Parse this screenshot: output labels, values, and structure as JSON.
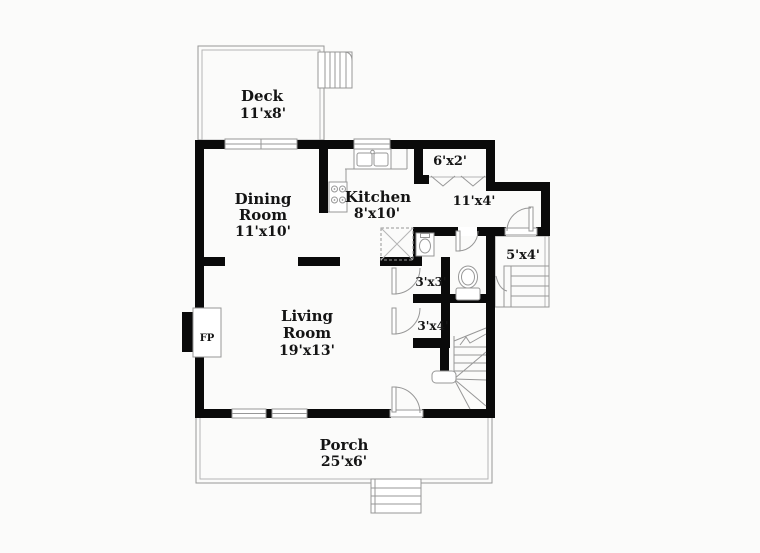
{
  "plan_title": "First floor plan",
  "colors": {
    "background": "#fbfbfa",
    "walls": "#0a0a0a",
    "thin_lines": "#979797",
    "text": "#141414"
  },
  "rooms": {
    "deck": {
      "name": "Deck",
      "dims": "11'x8'"
    },
    "dining_room": {
      "name_line1": "Dining",
      "name_line2": "Room",
      "dims": "11'x10'"
    },
    "kitchen": {
      "name": "Kitchen",
      "dims": "8'x10'"
    },
    "pantry_closet": {
      "dims": "6'x2'"
    },
    "hallway": {
      "dims": "11'x4'"
    },
    "side_stoop": {
      "dims": "5'x4'"
    },
    "closet_a": {
      "dims": "3'x3'"
    },
    "closet_b": {
      "dims": "3'x4'"
    },
    "living_room": {
      "name_line1": "Living",
      "name_line2": "Room",
      "dims": "19'x13'"
    },
    "porch": {
      "name": "Porch",
      "dims": "25'x6'"
    },
    "fireplace": {
      "abbr": "FP"
    }
  }
}
